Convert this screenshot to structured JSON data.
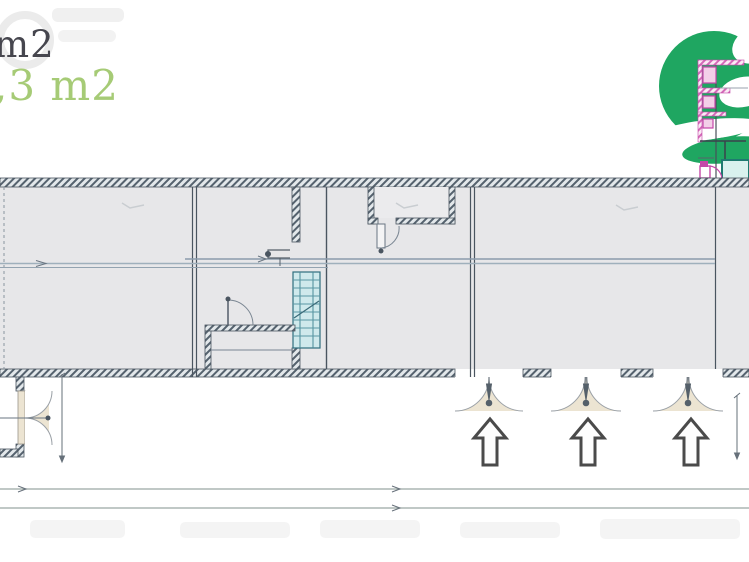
{
  "area_labels": {
    "primary_partial": "m2",
    "highlight_partial": ",3 m2"
  },
  "colors": {
    "logo_green": "#1fa661",
    "highlight_text_green": "#a6cb76",
    "primary_text_gray": "#46464e",
    "plan_interior_fill": "#e7e7e9",
    "wall_line": "#4a5560",
    "stairs_cyan": "#cfe9ec",
    "door_arc_beige": "#ece4d2",
    "fragment_magenta": "#c447a8",
    "teal_room_outline": "#1e7a70",
    "mid_guide_line": "#8c9cac",
    "dimension_line": "#9aa8a4"
  },
  "plan": {
    "entrance_arrow_count": 3,
    "entrance_openings": 3,
    "stairs_present": true,
    "icons": {
      "entrance_arrow": "outline-up-arrow",
      "brand_logo": "green-swirl-logo",
      "door_swing": "quarter-arc-door",
      "stairs": "hatched-stair-run"
    }
  }
}
